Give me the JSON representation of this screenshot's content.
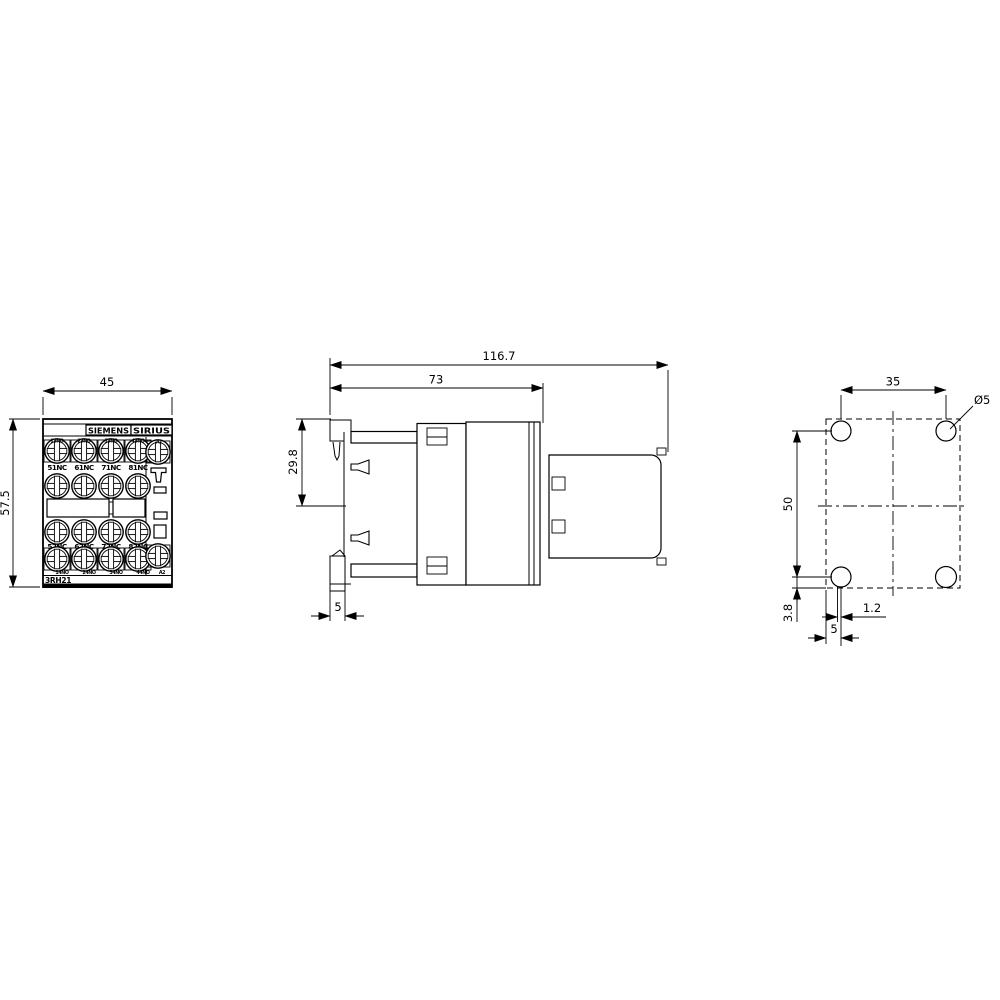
{
  "drawing": {
    "front_view": {
      "brand": "SIEMENS",
      "series": "SIRIUS",
      "model": "3RH21",
      "dim_width_mm": "45",
      "dim_height_mm": "57.5",
      "terminals": {
        "aux_top": [
          "51NC",
          "61NC",
          "71NC",
          "81NC"
        ],
        "aux_bottom": [
          "52NC",
          "62NC",
          "72NC",
          "82NC"
        ],
        "base_top": [
          "13NO",
          "23NO",
          "33NO",
          "43NO",
          "A1"
        ],
        "base_bottom": [
          "14NO",
          "24NO",
          "34NO",
          "44NO",
          "A2"
        ]
      }
    },
    "side_view": {
      "dim_total_depth_mm": "116.7",
      "dim_body_depth_mm": "73",
      "dim_clip_offset_mm": "29.8",
      "dim_rail_depth_mm": "5"
    },
    "drill_plan": {
      "dim_hole_spacing_horizontal_mm": "35",
      "dim_hole_spacing_vertical_mm": "50",
      "hole_diameter": "Ø5",
      "dim_offset_vertical_mm": "3.8",
      "dim_offset_horizontal_mm": "1.2",
      "dim_edge_distance_mm": "5"
    }
  }
}
